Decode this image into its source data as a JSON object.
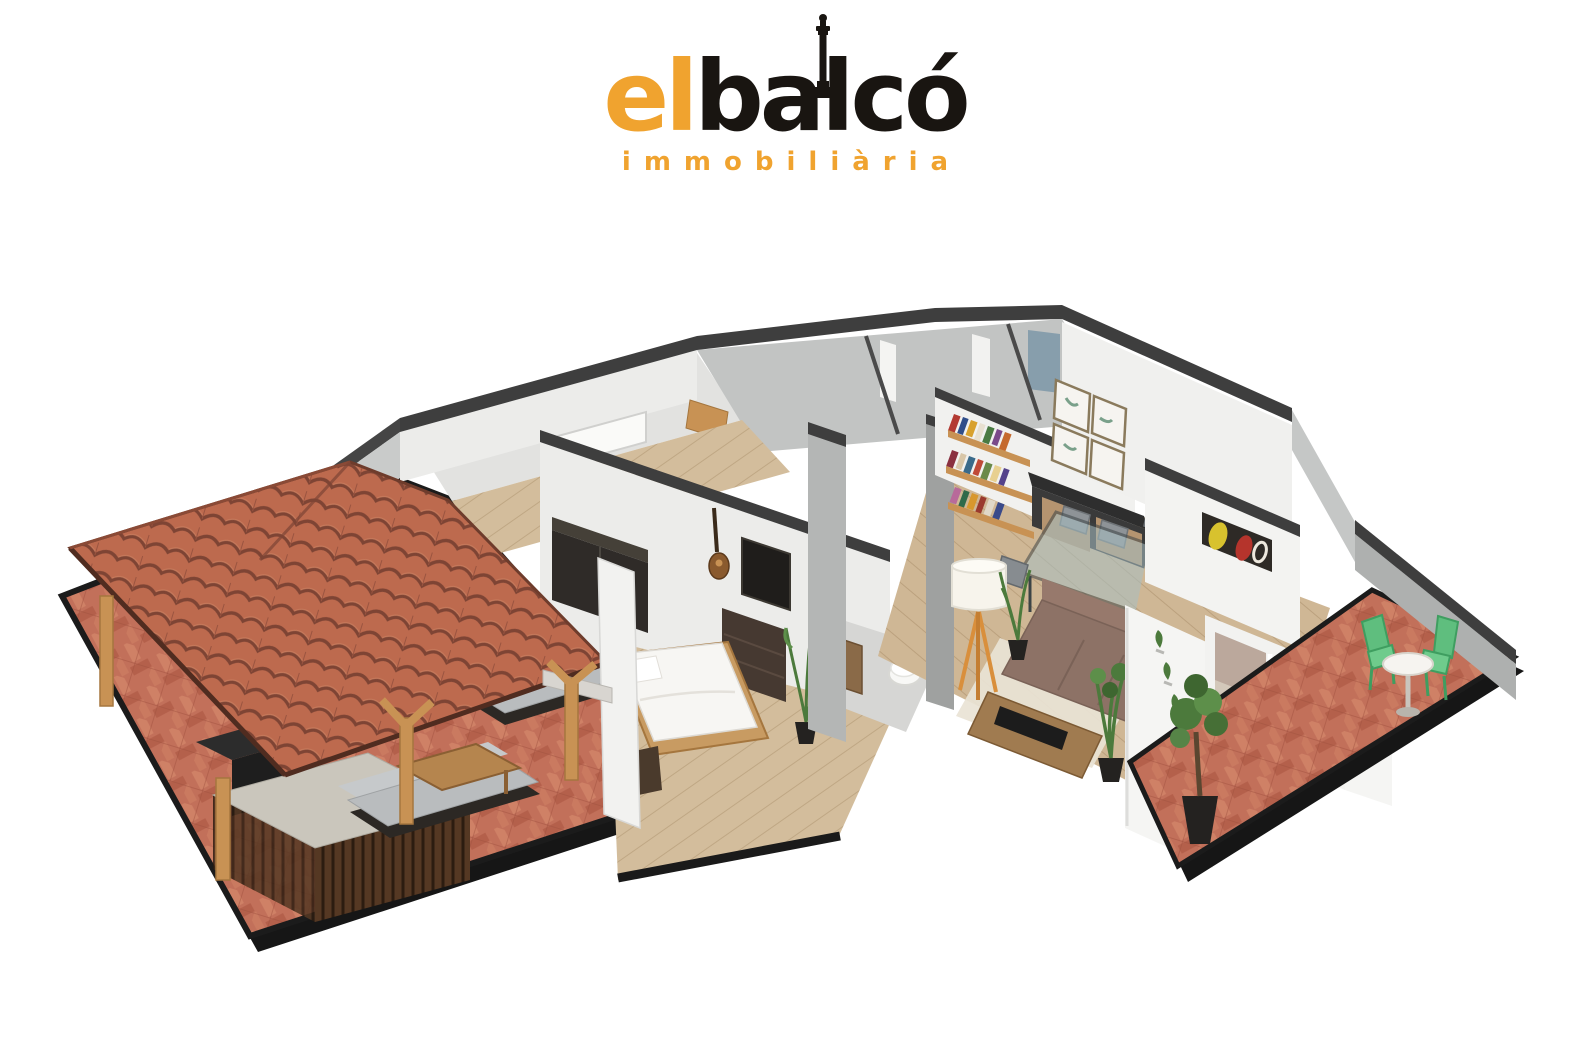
{
  "brand": {
    "logo_text_primary": "el",
    "logo_text_secondary": "balcó",
    "logo_subtitle": "immobiliària",
    "colors": {
      "brand_orange": "#F0A32F",
      "brand_black": "#191511"
    }
  },
  "scene": {
    "type": "3d-cutaway-floorplan-render",
    "background": "#ffffff",
    "areas": [
      {
        "name": "covered-terrace",
        "features": [
          "clay-tile pergola roof",
          "herringbone brick paving",
          "outdoor bar counter with timber slats",
          "barbecue",
          "outdoor corner sofa",
          "wooden coffee table",
          "timber posts"
        ]
      },
      {
        "name": "bedroom",
        "features": [
          "double bed",
          "dark wardrobe",
          "dresser with mirror",
          "nightstand",
          "guitar on wall",
          "potted plant"
        ]
      },
      {
        "name": "bathroom",
        "features": [
          "toilet",
          "wooden vanity"
        ]
      },
      {
        "name": "hallway",
        "features": [
          "wood flooring"
        ]
      },
      {
        "name": "utility-rooms",
        "features": [
          "shower enclosure",
          "white fixtures"
        ]
      },
      {
        "name": "living-dining-room",
        "features": [
          "wall bookshelves with books",
          "four framed prints",
          "dark sideboard with wood drawers",
          "glass dining table",
          "six grey chairs",
          "tripod floor lamp",
          "corner sofa",
          "media bench",
          "area rug",
          "potted plants",
          "abstract wall art"
        ]
      },
      {
        "name": "tv-room",
        "features": [
          "sofa with cushion",
          "sliding glass door"
        ]
      },
      {
        "name": "balcony",
        "features": [
          "herringbone brick paving",
          "round bistro table",
          "two green chairs",
          "potted tree",
          "wall planters"
        ]
      }
    ],
    "palette": {
      "roof_tile": "#BD6A4E",
      "roof_tile_shadow": "#7E4434",
      "brick_paving": "#C2705A",
      "platform_edge": "#161616",
      "wall_top": "#3E3E3E",
      "wall_white": "#F1F1EF",
      "wall_grey": "#C7C9C8",
      "wood_light": "#C89254",
      "wood_dark": "#553823",
      "floor_plank": "#CFB795",
      "outdoor_sofa": "#B9BCBE",
      "indoor_sofa": "#8D7266",
      "plant_green": "#4C7A3C",
      "balcony_chair_green": "#5FBE7E",
      "lamp_leg_orange": "#D98F3C",
      "glass_blue": "#A8C0C4"
    }
  }
}
